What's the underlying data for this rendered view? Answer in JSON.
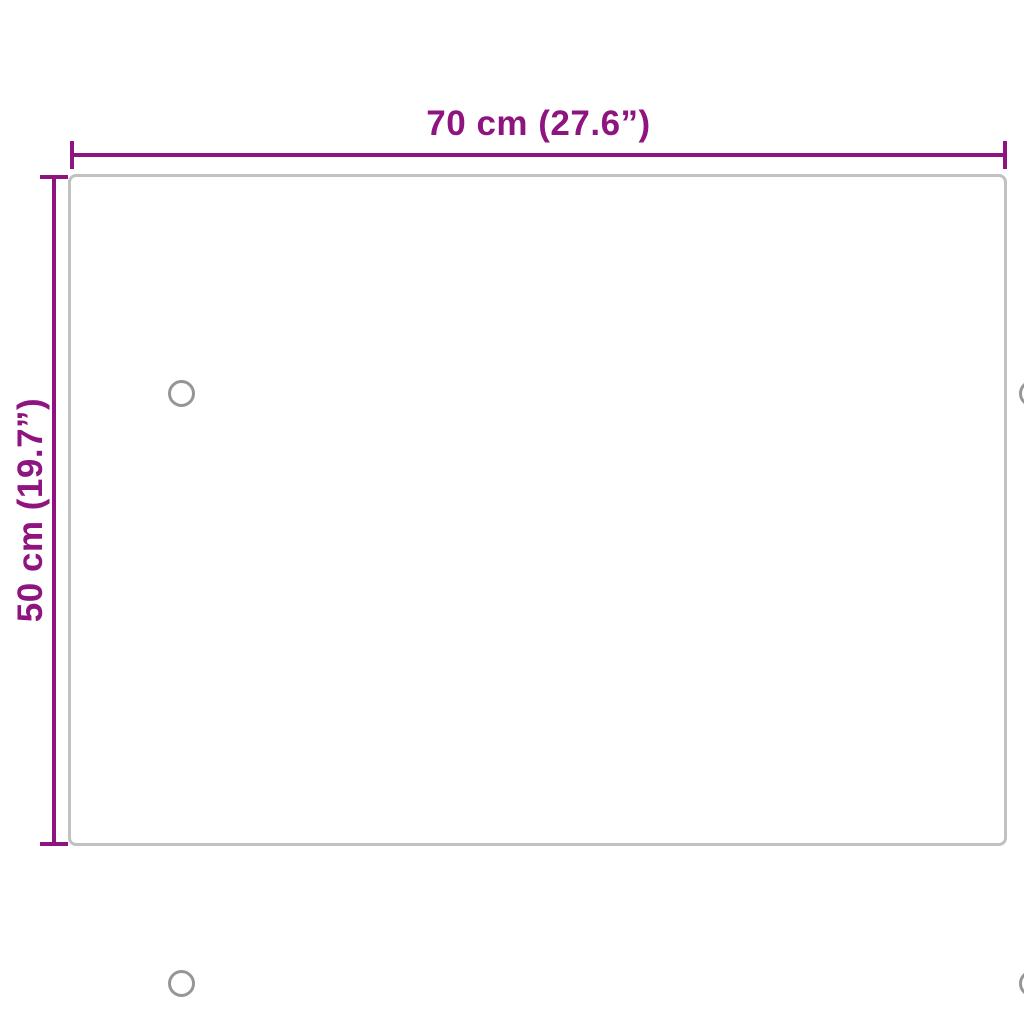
{
  "diagram": {
    "type": "product-dimensions",
    "width_label": "70 cm (27.6”)",
    "height_label": "50 cm (19.7”)",
    "panel": {
      "shape": "rectangle",
      "mounting_holes": 4
    },
    "colors": {
      "dimension_accent": "#8E157F",
      "panel_border": "#C1C1C1",
      "hole_border": "#969696",
      "background": "#FFFFFF"
    }
  }
}
